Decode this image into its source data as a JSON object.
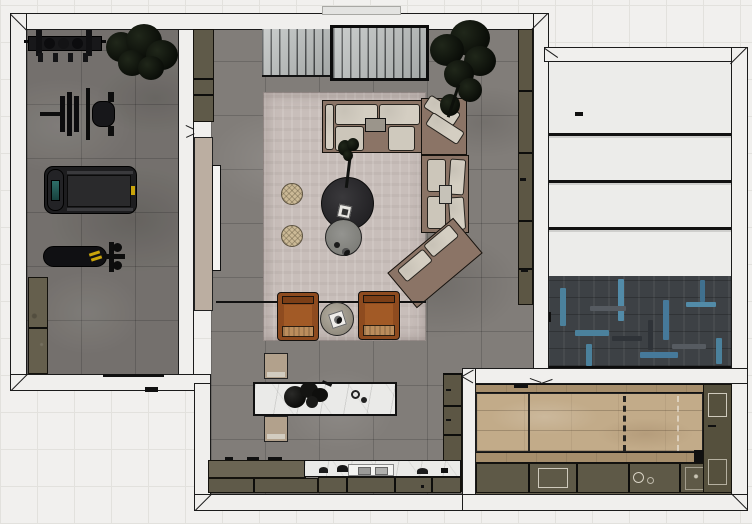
{
  "scene": {
    "title": "Apartment floor plan — top-down 3D render",
    "view": "top-down",
    "rooms": {
      "gym": {
        "label": "Home gym",
        "floor_material": "grey stone tile",
        "items": {
          "dumbbell_rack": "Dumbbell rack",
          "plant": "Potted plant",
          "bench_press": "Bench press station",
          "treadmill": "Treadmill",
          "weight_bench": "Weight bench",
          "cabinet": "Storage cabinet"
        }
      },
      "living": {
        "label": "Living room",
        "floor_material": "grey stone tile",
        "items": {
          "wardrobe_slatted": "Slatted wardrobe",
          "wardrobe_framed": "Framed slatted wardrobe",
          "wall_cabinet": "Tall cabinet",
          "tan_panel": "Wall panel",
          "sliding_door": "Sliding door",
          "plant": "Tall plant",
          "rug": "Area rug",
          "sofa": "Sectional sofa",
          "coffee_table_dark": "Round coffee table, dark",
          "coffee_table_grey": "Round coffee table, grey",
          "table_plant": "Vase with branches",
          "pouf_top": "Round pouf",
          "pouf_bottom": "Round pouf",
          "console": "Slim console rail",
          "armchair_left": "Leather armchair",
          "armchair_right": "Leather armchair",
          "side_table": "Round side table",
          "wall_shelf": "Wall shelf unit",
          "wall_shelf_lower": "Lower wall shelf"
        }
      },
      "kitchen": {
        "label": "Kitchen",
        "floor_material": "grey stone tile",
        "items": {
          "island": "Marble island",
          "island_decor": "Flower bowl",
          "bench_top": "Bench",
          "bench_bottom": "Bench",
          "counter_left": "Counter",
          "counter_marble": "Marble counter",
          "cooktop": "Cooktop",
          "base_cabinets": "Base cabinets"
        }
      },
      "garage": {
        "label": "Garage",
        "floor_material": "herringbone tile",
        "items": {
          "sectional_door": "Sectional garage door",
          "herringbone_floor": "Herringbone floor tiles"
        }
      },
      "games": {
        "label": "Games room",
        "floor_material": "wood planks",
        "items": {
          "game_table": "Wood game table",
          "center_line": "Dashed centre line",
          "lower_cabinets": "Lower cabinet run",
          "side_cabinet": "Side cabinet column",
          "drawer": "Drawer unit"
        }
      }
    },
    "palette": {
      "background": "#f1f0ee",
      "grid_line": "#e2e1dd",
      "wall_fill": "#f0efed",
      "wall_outline": "#1b1b1b",
      "stone_floor": "#817d79",
      "rug": "#c8beba",
      "wood_floor": "#c2ab89",
      "olive_cabinet": "#655f4d",
      "marble": "#eaeae8",
      "sofa_frame": "#8b7466",
      "cushion": "#d4cec2",
      "armchair": "#95491c",
      "armchair_cushion": "#bb8d5c",
      "herringbone_base": "#3d4145",
      "herringbone_accent": "#4b819c",
      "bench_tan": "#b2a18c",
      "treadmill_screen": "#2e6e68",
      "accent_yellow": "#c9a40b"
    }
  }
}
